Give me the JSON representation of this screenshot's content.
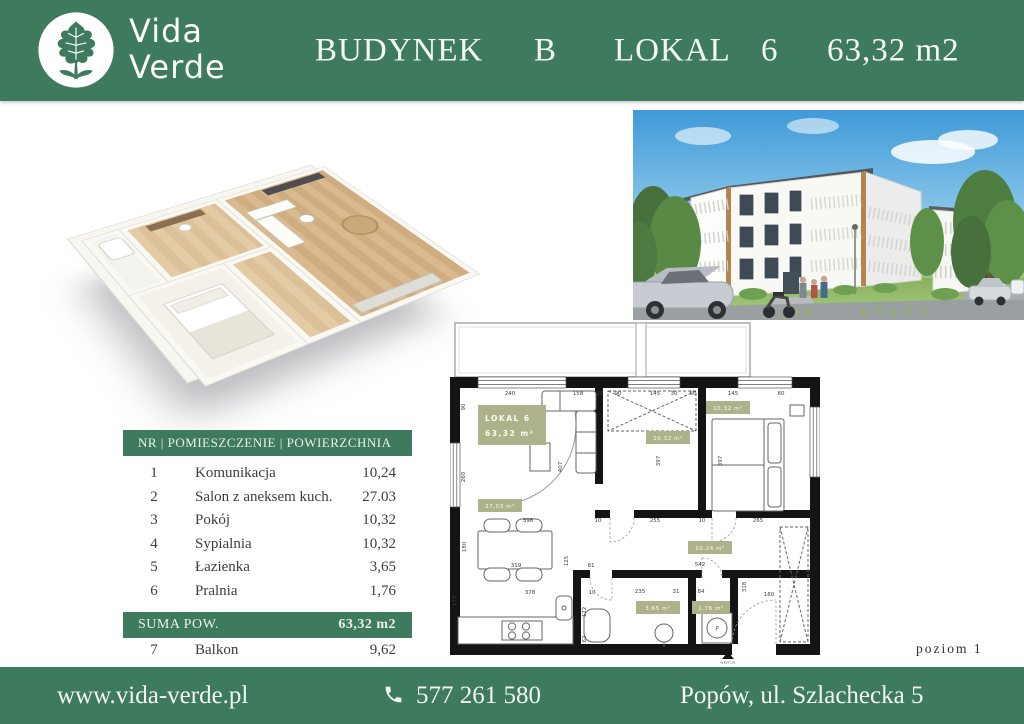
{
  "theme": {
    "green": "#3d7a5e",
    "olive": "#adb28a",
    "ink": "#3d3d3d",
    "wall": "#141414"
  },
  "header": {
    "logo": {
      "line1": "Vida",
      "line2": "Verde"
    },
    "title": {
      "building_label": "BUDYNEK",
      "building_value": "B",
      "unit_label": "LOKAL",
      "unit_value": "6",
      "area": "63,32 m2"
    }
  },
  "room_table": {
    "header": "NR | POMIESZCZENIE | POWIERZCHNIA",
    "rows": [
      {
        "nr": "1",
        "name": "Komunikacja",
        "area": "10,24"
      },
      {
        "nr": "2",
        "name": "Salon z aneksem kuch.",
        "area": "27.03"
      },
      {
        "nr": "3",
        "name": "Pokój",
        "area": "10,32"
      },
      {
        "nr": "4",
        "name": "Sypialnia",
        "area": "10,32"
      },
      {
        "nr": "5",
        "name": "Łazienka",
        "area": "3,65"
      },
      {
        "nr": "6",
        "name": "Pralnia",
        "area": "1,76"
      }
    ],
    "sum_label": "SUMA POW.",
    "sum_value": "63,32 m2",
    "extra_row": {
      "nr": "7",
      "name": "Balkon",
      "area": "9,62"
    }
  },
  "floor_plan": {
    "unit_box": {
      "line1": "LOKAL 6",
      "line2": "63,32 m²"
    },
    "areas": {
      "salon": "27,03 m²",
      "pokoj": "10,32 m²",
      "sypialnia": "10,32 m²",
      "komunikacja": "10,24 m²",
      "lazienka": "3,65 m²",
      "pralnia": "1,76 m²"
    },
    "washer_letter": "P",
    "entrance_label": "WEJŚCIE",
    "dims": [
      {
        "t": "240",
        "x": 60,
        "y": 80
      },
      {
        "t": "158",
        "x": 128,
        "y": 80
      },
      {
        "t": "10",
        "x": 150,
        "y": 80
      },
      {
        "t": "90",
        "x": 168,
        "y": 80
      },
      {
        "t": "145",
        "x": 205,
        "y": 80
      },
      {
        "t": "30",
        "x": 224,
        "y": 80
      },
      {
        "t": "60",
        "x": 243,
        "y": 80
      },
      {
        "t": "145",
        "x": 283,
        "y": 80
      },
      {
        "t": "60",
        "x": 331,
        "y": 80
      },
      {
        "t": "90",
        "x": 15,
        "y": 92,
        "r": true
      },
      {
        "t": "260",
        "x": 15,
        "y": 162,
        "r": true
      },
      {
        "t": "180",
        "x": 16,
        "y": 232,
        "r": true
      },
      {
        "t": "175",
        "x": 6,
        "y": 286,
        "r": true
      },
      {
        "t": "398",
        "x": 78,
        "y": 207
      },
      {
        "t": "10",
        "x": 148,
        "y": 207
      },
      {
        "t": "255",
        "x": 205,
        "y": 207
      },
      {
        "t": "10",
        "x": 252,
        "y": 207
      },
      {
        "t": "265",
        "x": 308,
        "y": 207
      },
      {
        "t": "407",
        "x": 112,
        "y": 152,
        "r": true
      },
      {
        "t": "397",
        "x": 210,
        "y": 146,
        "r": true
      },
      {
        "t": "397",
        "x": 272,
        "y": 146,
        "r": true
      },
      {
        "t": "319",
        "x": 66,
        "y": 252
      },
      {
        "t": "125",
        "x": 118,
        "y": 246,
        "r": true
      },
      {
        "t": "81",
        "x": 141,
        "y": 252
      },
      {
        "t": "542",
        "x": 250,
        "y": 251
      },
      {
        "t": "378",
        "x": 80,
        "y": 279
      },
      {
        "t": "10",
        "x": 142,
        "y": 279
      },
      {
        "t": "235",
        "x": 190,
        "y": 278
      },
      {
        "t": "31",
        "x": 226,
        "y": 278
      },
      {
        "t": "84",
        "x": 251,
        "y": 278
      },
      {
        "t": "122",
        "x": 136,
        "y": 297,
        "r": true
      },
      {
        "t": "62",
        "x": 136,
        "y": 324,
        "r": true
      },
      {
        "t": "318",
        "x": 296,
        "y": 272,
        "r": true
      },
      {
        "t": "180",
        "x": 319,
        "y": 281
      }
    ]
  },
  "level_label": "poziom 1",
  "footer": {
    "website": "www.vida-verde.pl",
    "phone": "577 261 580",
    "address": "Popów, ul. Szlachecka 5"
  }
}
